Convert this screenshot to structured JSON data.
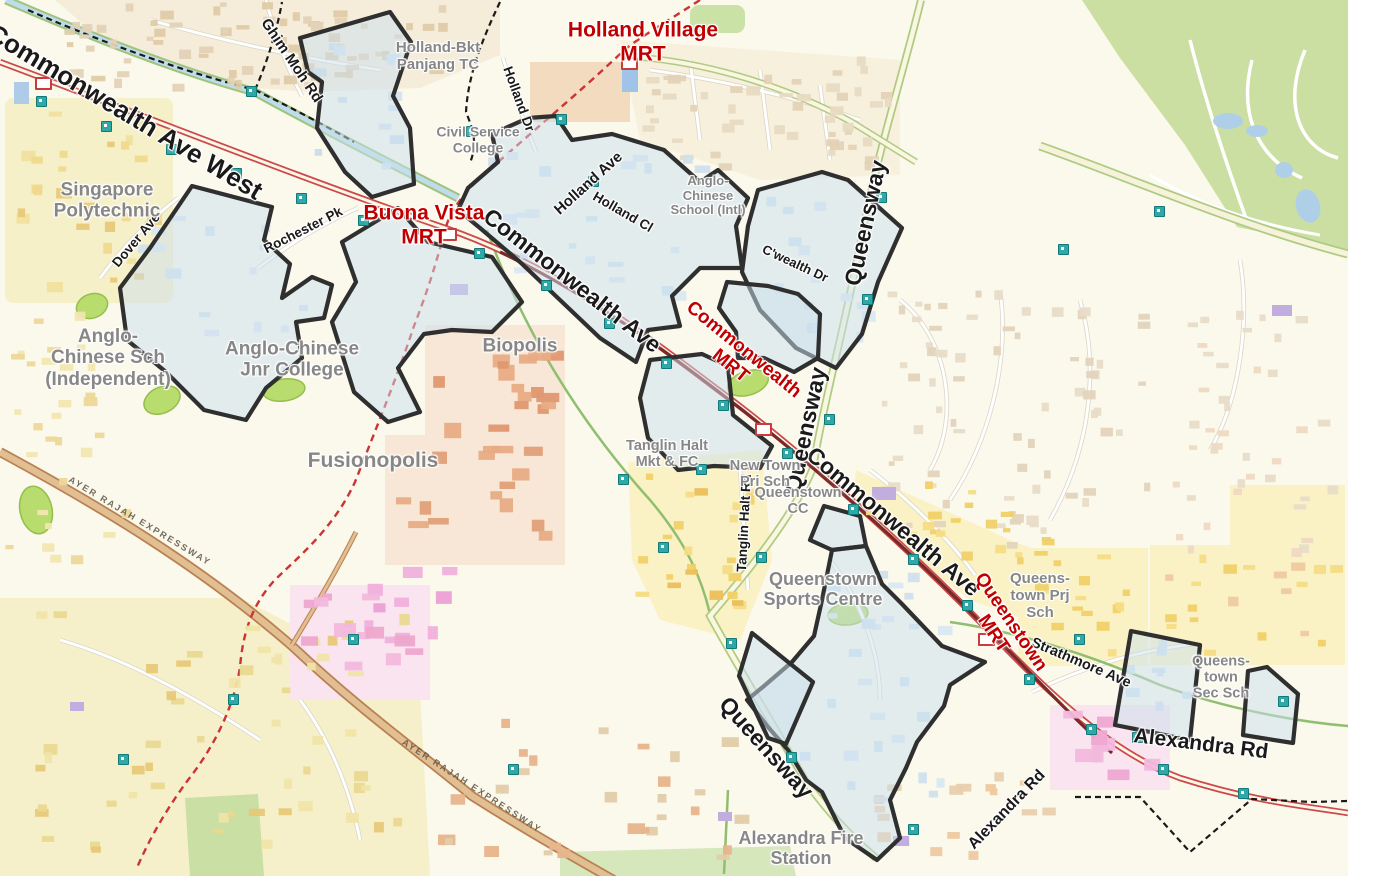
{
  "map": {
    "background_color": "#FBF8EC",
    "colors": {
      "mrt_label": "#C00000",
      "road_label": "#1A1A1A",
      "place_label": "#878787",
      "estate_outline": "#2F2F2F",
      "estate_fill": "#CBE0EE",
      "corridor_red": "#C84848",
      "mrt_track_maroon": "#7A2828",
      "expressway_brown": "#B98050",
      "park_green": "#CBDFA2",
      "canal_blue": "#BFDCEA",
      "bus_stop_teal": "#2FA8A8",
      "dashed_boundary": "#1A1A1A",
      "construction_line_red": "#CC3333"
    },
    "road_labels": [
      {
        "text": "Commonwealth Ave West",
        "x": 125,
        "y": 112,
        "rot": 31,
        "fs": 26
      },
      {
        "text": "Commonwealth Ave",
        "x": 572,
        "y": 281,
        "rot": 38,
        "fs": 23
      },
      {
        "text": "Commonwealth Ave",
        "x": 893,
        "y": 522,
        "rot": 40,
        "fs": 23
      },
      {
        "text": "Queensway",
        "x": 866,
        "y": 223,
        "rot": -78,
        "fs": 23
      },
      {
        "text": "Queensway",
        "x": 806,
        "y": 430,
        "rot": -78,
        "fs": 23
      },
      {
        "text": "Queensway",
        "x": 766,
        "y": 748,
        "rot": 48,
        "fs": 23
      },
      {
        "text": "Ghim Moh Rd",
        "x": 291,
        "y": 61,
        "rot": 56,
        "fs": 15
      },
      {
        "text": "Holland Dr",
        "x": 519,
        "y": 99,
        "rot": 70,
        "fs": 13.5
      },
      {
        "text": "Holland Ave",
        "x": 589,
        "y": 184,
        "rot": -42,
        "fs": 15
      },
      {
        "text": "Holland Cl",
        "x": 623,
        "y": 212,
        "rot": 30,
        "fs": 13.5
      },
      {
        "text": "C'wealth Dr",
        "x": 795,
        "y": 264,
        "rot": 25,
        "fs": 13
      },
      {
        "text": "Dover Ave",
        "x": 136,
        "y": 240,
        "rot": -50,
        "fs": 13.5
      },
      {
        "text": "Rochester Pk",
        "x": 303,
        "y": 230,
        "rot": -27,
        "fs": 13.5
      },
      {
        "text": "Tanglin Halt Rd",
        "x": 744,
        "y": 523,
        "rot": -87,
        "fs": 13.5
      },
      {
        "text": "Strathmore Ave",
        "x": 1081,
        "y": 663,
        "rot": 23,
        "fs": 14.5
      },
      {
        "text": "Alexandra Rd",
        "x": 1201,
        "y": 744,
        "rot": 7,
        "fs": 21
      },
      {
        "text": "Alexandra Rd",
        "x": 1007,
        "y": 810,
        "rot": -46,
        "fs": 16
      }
    ],
    "expressway_labels": [
      {
        "text": "AYER RAJAH EXPRESSWAY",
        "x": 140,
        "y": 521,
        "rot": 31,
        "fs": 9
      },
      {
        "text": "AYER RAJAH EXPRESSWAY",
        "x": 472,
        "y": 786,
        "rot": 33,
        "fs": 9
      }
    ],
    "mrt_labels": [
      {
        "text": "Holland Village\nMRT",
        "x": 643,
        "y": 42,
        "rot": 0,
        "fs": 21
      },
      {
        "text": "Buona Vista\nMRT",
        "x": 424,
        "y": 225,
        "rot": 0,
        "fs": 21
      },
      {
        "text": "Commonwealth\nMRT",
        "x": 737,
        "y": 358,
        "rot": 39,
        "fs": 19
      },
      {
        "text": "Queenstown\nMRT",
        "x": 1002,
        "y": 628,
        "rot": 56,
        "fs": 19
      }
    ],
    "place_labels": [
      {
        "text": "Singapore\nPolytechnic",
        "x": 107,
        "y": 201,
        "fs": 19
      },
      {
        "text": "Anglo-\nChinese Sch\n(Independent)",
        "x": 108,
        "y": 358,
        "fs": 19
      },
      {
        "text": "Anglo-Chinese\nJnr College",
        "x": 292,
        "y": 360,
        "fs": 19
      },
      {
        "text": "Biopolis",
        "x": 520,
        "y": 346,
        "fs": 19
      },
      {
        "text": "Fusionopolis",
        "x": 373,
        "y": 461,
        "fs": 21
      },
      {
        "text": "Holland-Bkt\nPanjang TC",
        "x": 438,
        "y": 57,
        "fs": 15
      },
      {
        "text": "Civil Service\nCollege",
        "x": 478,
        "y": 140,
        "fs": 14
      },
      {
        "text": "Anglo-\nChinese\nSchool (Intl)",
        "x": 708,
        "y": 196,
        "fs": 13
      },
      {
        "text": "Tanglin Halt\nMkt & FC",
        "x": 667,
        "y": 454,
        "fs": 14.5
      },
      {
        "text": "New Town\nPri Sch",
        "x": 765,
        "y": 474,
        "fs": 14.5
      },
      {
        "text": "Queenstown\nCC",
        "x": 798,
        "y": 501,
        "fs": 14.5
      },
      {
        "text": "Queenstown\nSports Centre",
        "x": 823,
        "y": 589,
        "fs": 18
      },
      {
        "text": "Queens-\ntown Prj\nSch",
        "x": 1040,
        "y": 596,
        "fs": 15
      },
      {
        "text": "Queens-\ntown\nSec Sch",
        "x": 1221,
        "y": 678,
        "fs": 14.5
      },
      {
        "text": "Alexandra Fire\nStation",
        "x": 801,
        "y": 848,
        "fs": 18
      }
    ],
    "icons": {
      "bus_stops": [
        [
          40,
          100
        ],
        [
          105,
          125
        ],
        [
          170,
          148
        ],
        [
          235,
          172
        ],
        [
          300,
          197
        ],
        [
          362,
          219
        ],
        [
          478,
          252
        ],
        [
          545,
          284
        ],
        [
          608,
          322
        ],
        [
          665,
          362
        ],
        [
          722,
          404
        ],
        [
          786,
          452
        ],
        [
          852,
          508
        ],
        [
          912,
          558
        ],
        [
          966,
          604
        ],
        [
          1028,
          678
        ],
        [
          1090,
          728
        ],
        [
          1162,
          768
        ],
        [
          1242,
          792
        ],
        [
          880,
          196
        ],
        [
          866,
          298
        ],
        [
          828,
          418
        ],
        [
          760,
          556
        ],
        [
          730,
          642
        ],
        [
          790,
          756
        ],
        [
          1078,
          638
        ],
        [
          1136,
          736
        ],
        [
          1282,
          700
        ],
        [
          622,
          478
        ],
        [
          662,
          546
        ],
        [
          700,
          468
        ],
        [
          560,
          118
        ],
        [
          592,
          180
        ],
        [
          1062,
          248
        ],
        [
          1158,
          210
        ],
        [
          352,
          638
        ],
        [
          232,
          698
        ],
        [
          122,
          758
        ],
        [
          512,
          768
        ],
        [
          912,
          828
        ],
        [
          250,
          90
        ],
        [
          470,
          130
        ]
      ],
      "mrt_stations": [
        [
          447,
          233
        ],
        [
          628,
          62
        ],
        [
          762,
          428
        ],
        [
          985,
          638
        ],
        [
          42,
          82
        ]
      ]
    }
  }
}
